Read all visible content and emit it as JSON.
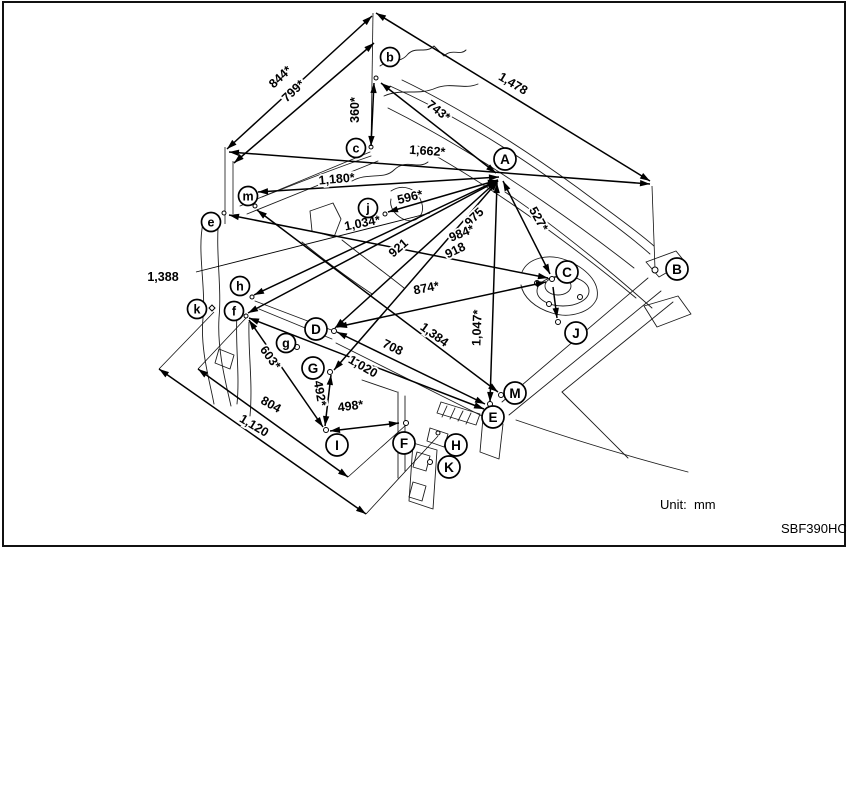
{
  "page": {
    "unit_label": "Unit:  mm",
    "figure_code": "SBF390HC"
  },
  "diagram": {
    "frame": {
      "x": 3,
      "y": 2,
      "w": 842,
      "h": 544
    },
    "points": [
      {
        "letter": "b",
        "x": 390,
        "y": 57,
        "size": "small"
      },
      {
        "letter": "c",
        "x": 356,
        "y": 148,
        "size": "small"
      },
      {
        "letter": "A",
        "x": 505,
        "y": 159,
        "size": "large"
      },
      {
        "letter": "B",
        "x": 677,
        "y": 269,
        "size": "large"
      },
      {
        "letter": "C",
        "x": 567,
        "y": 272,
        "size": "large"
      },
      {
        "letter": "m",
        "x": 248,
        "y": 196,
        "size": "small"
      },
      {
        "letter": "e",
        "x": 211,
        "y": 222,
        "size": "small"
      },
      {
        "letter": "j",
        "x": 368,
        "y": 208,
        "size": "small"
      },
      {
        "letter": "h",
        "x": 240,
        "y": 286,
        "size": "small"
      },
      {
        "letter": "k",
        "x": 197,
        "y": 309,
        "size": "small"
      },
      {
        "letter": "f",
        "x": 234,
        "y": 311,
        "size": "small"
      },
      {
        "letter": "D",
        "x": 316,
        "y": 329,
        "size": "large"
      },
      {
        "letter": "g",
        "x": 286,
        "y": 343,
        "size": "small"
      },
      {
        "letter": "G",
        "x": 313,
        "y": 368,
        "size": "large"
      },
      {
        "letter": "J",
        "x": 576,
        "y": 333,
        "size": "large"
      },
      {
        "letter": "M",
        "x": 515,
        "y": 393,
        "size": "large"
      },
      {
        "letter": "E",
        "x": 493,
        "y": 417,
        "size": "large"
      },
      {
        "letter": "I",
        "x": 337,
        "y": 445,
        "size": "large"
      },
      {
        "letter": "F",
        "x": 404,
        "y": 443,
        "size": "large"
      },
      {
        "letter": "H",
        "x": 456,
        "y": 445,
        "size": "large"
      },
      {
        "letter": "K",
        "x": 449,
        "y": 467,
        "size": "large"
      }
    ],
    "dimensions": [
      {
        "label": "844*",
        "x1": 227,
        "y1": 149,
        "x2": 372,
        "y2": 16,
        "lx": 283,
        "ly": 80,
        "rot": -43
      },
      {
        "label": "799*",
        "x1": 234,
        "y1": 163,
        "x2": 374,
        "y2": 43,
        "lx": 296,
        "ly": 94,
        "rot": -43
      },
      {
        "label": "360*",
        "x1": 374,
        "y1": 83,
        "x2": 371,
        "y2": 146,
        "lx": 359,
        "ly": 110,
        "rot": -90
      },
      {
        "label": "743*",
        "x1": 381,
        "y1": 83,
        "x2": 496,
        "y2": 173,
        "lx": 436,
        "ly": 114,
        "rot": 38
      },
      {
        "label": "1,478",
        "x1": 376,
        "y1": 13,
        "x2": 650,
        "y2": 181,
        "lx": 511,
        "ly": 87,
        "rot": 31
      },
      {
        "label": "1,662*",
        "x1": 229,
        "y1": 152,
        "x2": 650,
        "y2": 184,
        "lx": 427,
        "ly": 155,
        "rot": 4
      },
      {
        "label": "1,180*",
        "x1": 499,
        "y1": 177,
        "x2": 258,
        "y2": 192,
        "lx": 337,
        "ly": 183,
        "rot": -5
      },
      {
        "label": "596*",
        "x1": 498,
        "y1": 180,
        "x2": 388,
        "y2": 212,
        "lx": 411,
        "ly": 201,
        "rot": -14
      },
      {
        "label": "1,034*",
        "x1": 229,
        "y1": 215,
        "x2": 548,
        "y2": 278,
        "lx": 363,
        "ly": 227,
        "rot": -11
      },
      {
        "label": "921",
        "x1": 335,
        "y1": 328,
        "x2": 497,
        "y2": 181,
        "lx": 401,
        "ly": 251,
        "rot": -41
      },
      {
        "label": "975",
        "x1": 498,
        "y1": 181,
        "x2": 334,
        "y2": 370,
        "lx": 477,
        "ly": 220,
        "rot": -44
      },
      {
        "label": "984*",
        "x1": 498,
        "y1": 180,
        "x2": 254,
        "y2": 295,
        "lx": 463,
        "ly": 237,
        "rot": -22
      },
      {
        "label": "918",
        "x1": 497,
        "y1": 181,
        "x2": 248,
        "y2": 313,
        "lx": 457,
        "ly": 254,
        "rot": -26
      },
      {
        "label": "527*",
        "x1": 503,
        "y1": 181,
        "x2": 550,
        "y2": 274,
        "lx": 535,
        "ly": 221,
        "rot": 61
      },
      {
        "label": "874*",
        "x1": 337,
        "y1": 327,
        "x2": 546,
        "y2": 282,
        "lx": 427,
        "ly": 292,
        "rot": -11
      },
      {
        "label": "1,384",
        "x1": 257,
        "y1": 210,
        "x2": 498,
        "y2": 392,
        "lx": 432,
        "ly": 338,
        "rot": 36
      },
      {
        "label": "708",
        "x1": 337,
        "y1": 332,
        "x2": 485,
        "y2": 404,
        "lx": 391,
        "ly": 351,
        "rot": 26
      },
      {
        "label": "1,020",
        "x1": 249,
        "y1": 318,
        "x2": 484,
        "y2": 409,
        "lx": 361,
        "ly": 370,
        "rot": 30
      },
      {
        "label": "603*",
        "x1": 249,
        "y1": 320,
        "x2": 323,
        "y2": 427,
        "lx": 267,
        "ly": 360,
        "rot": 54
      },
      {
        "label": "492*",
        "x1": 331,
        "y1": 375,
        "x2": 325,
        "y2": 426,
        "lx": 316,
        "ly": 394,
        "rot": 80
      },
      {
        "label": "498*",
        "x1": 330,
        "y1": 431,
        "x2": 399,
        "y2": 423,
        "lx": 351,
        "ly": 410,
        "rot": -7
      },
      {
        "label": "804",
        "x1": 198,
        "y1": 369,
        "x2": 348,
        "y2": 477,
        "lx": 269,
        "ly": 408,
        "rot": 29
      },
      {
        "label": "1,120",
        "x1": 159,
        "y1": 369,
        "x2": 366,
        "y2": 514,
        "lx": 252,
        "ly": 429,
        "rot": 31
      },
      {
        "label": "1,047*",
        "x1": 497,
        "y1": 183,
        "x2": 490,
        "y2": 402,
        "lx": 481,
        "ly": 328,
        "rot": -88
      },
      {
        "label": "1,388",
        "x1": 196,
        "y1": 272,
        "x2": 430,
        "y2": 213,
        "lx": 163,
        "ly": 281,
        "rot": 0,
        "heads": "none",
        "thin": true
      },
      {
        "label": "",
        "x1": 553,
        "y1": 287,
        "x2": 557,
        "y2": 318,
        "heads": "end"
      }
    ],
    "extensions": [
      [
        373,
        13,
        371,
        148
      ],
      [
        225,
        147,
        225,
        224
      ],
      [
        233,
        161,
        233,
        214
      ],
      [
        652,
        186,
        655,
        269
      ],
      [
        159,
        369,
        214,
        312
      ],
      [
        198,
        369,
        246,
        318
      ],
      [
        348,
        477,
        406,
        425
      ],
      [
        366,
        514,
        438,
        436
      ],
      [
        290,
        345,
        296,
        347
      ]
    ],
    "markers": [
      {
        "x": 376,
        "y": 78,
        "r": 2
      },
      {
        "x": 371,
        "y": 147,
        "r": 2
      },
      {
        "x": 385,
        "y": 214,
        "r": 2
      },
      {
        "x": 255,
        "y": 206,
        "r": 2
      },
      {
        "x": 224,
        "y": 213,
        "r": 2
      },
      {
        "x": 252,
        "y": 297,
        "r": 2
      },
      {
        "x": 246,
        "y": 316,
        "r": 2
      },
      {
        "x": 212,
        "y": 308,
        "r": 3,
        "shape": "diamond"
      },
      {
        "x": 334,
        "y": 331,
        "r": 2.5
      },
      {
        "x": 297,
        "y": 347,
        "r": 2.5
      },
      {
        "x": 330,
        "y": 372,
        "r": 2.5
      },
      {
        "x": 326,
        "y": 430,
        "r": 2.5
      },
      {
        "x": 406,
        "y": 423,
        "r": 2.5
      },
      {
        "x": 438,
        "y": 433,
        "r": 2
      },
      {
        "x": 430,
        "y": 462,
        "r": 2.5
      },
      {
        "x": 490,
        "y": 404,
        "r": 2.5
      },
      {
        "x": 501,
        "y": 395,
        "r": 2.5
      },
      {
        "x": 558,
        "y": 322,
        "r": 2.5
      },
      {
        "x": 552,
        "y": 279,
        "r": 2.5
      },
      {
        "x": 655,
        "y": 270,
        "r": 3
      },
      {
        "x": 537,
        "y": 283,
        "r": 2.5
      },
      {
        "x": 580,
        "y": 297,
        "r": 2.5
      },
      {
        "x": 549,
        "y": 304,
        "r": 2.5
      }
    ],
    "artwork": [
      "M380,66 C392,58 400,64 408,54 C416,46 426,54 434,46 L444,56 C452,48 460,56 466,50",
      "M384,96 C402,88 418,96 436,88 C452,82 464,90 478,84",
      "M390,86 C448,112 506,146 566,190 C600,214 630,236 650,254",
      "M402,80 C460,108 520,146 578,188 C610,212 636,230 654,246",
      "M388,108 C440,134 492,166 544,202 C576,224 606,246 634,268",
      "M418,146 C462,170 508,200 554,234 C584,256 612,278 636,298",
      "M505,192 C535,212 566,236 598,262 C618,278 636,294 652,308",
      "M240,206 L370,152",
      "M247,214 L378,161",
      "M262,197 C300,182 336,168 371,156",
      "M203,223 C197,252 206,286 203,318 C200,350 210,382 214,404",
      "M219,216 C215,250 222,286 219,318 C217,350 226,384 231,406",
      "M237,314 C235,344 240,374 237,404",
      "M249,322 C248,352 253,382 250,416",
      "M219,349 l15,6 l-4,14 l-15,-6 Z",
      "M310,211 L333,203 L341,219 L334,237 L312,231 Z",
      "M352,181 C368,172 384,180 394,170 C406,158 418,170 428,162",
      "M391,191 C403,183 417,189 421,201 C427,215 415,225 403,219 C395,215 389,207 391,199",
      "M342,240 C362,256 384,272 404,288",
      "M302,242 C324,260 348,278 372,294",
      "M255,301 L334,331",
      "M259,309 L332,339",
      "M336,343 L482,416",
      "M537,291 a26,15 0 1 0 52,0 a26,15 0 1 0 -52,0",
      "M545,286 a13,9 0 1 0 26,0 a13,9 0 1 0 -26,0",
      "M522,272 C528,258 548,253 566,260 C586,268 600,282 597,298",
      "M597,298 C592,312 570,319 552,313 C535,308 523,297 521,285",
      "M648,278 L502,402",
      "M661,291 L509,415",
      "M673,302 L562,392",
      "M562,392 C582,412 606,436 628,458",
      "M516,420 C574,440 634,458 688,472",
      "M646,262 L676,251 L685,262 L659,277 Z",
      "M644,306 L678,296 L691,314 L657,327 Z",
      "M398,392 L398,478",
      "M405,396 L405,471",
      "M362,380 L397,392",
      "M441,402 L480,414 L476,425 L437,413 Z",
      "M447,406 L442,417",
      "M455,408 L450,419",
      "M463,411 L458,421",
      "M471,413 L466,424",
      "M413,443 L437,450 L433,509 L409,501 Z",
      "M417,452 l13,4 l-4,15 l-13,-4 Z",
      "M413,482 l13,4 l-4,15 l-13,-4 Z",
      "M483,418 L503,424 L499,459 L480,452 Z",
      "M430,428 L448,434 L444,447 L427,441 Z"
    ]
  }
}
